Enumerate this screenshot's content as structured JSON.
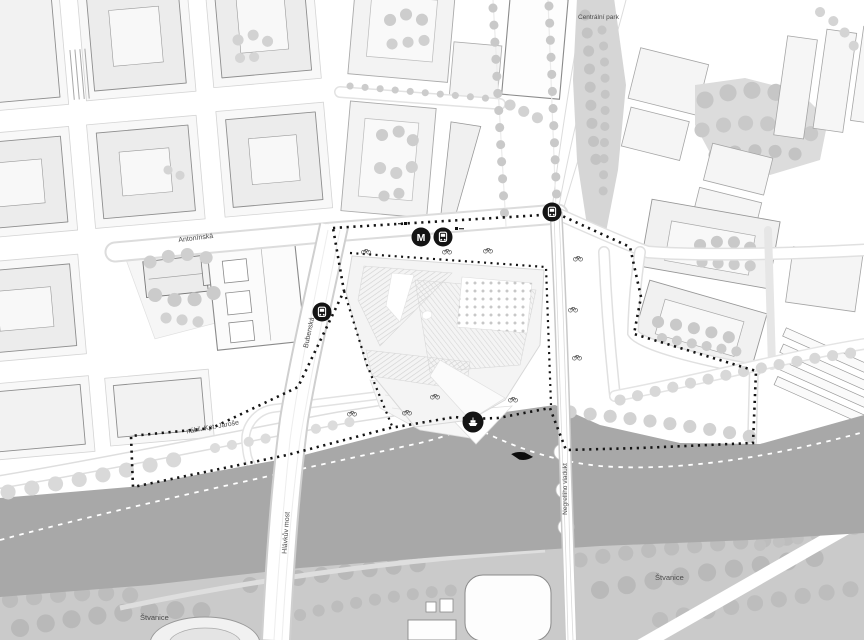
{
  "labels": {
    "central_park": "Centrální park",
    "antoninska": "Antonínská",
    "bubenska": "Bubenská",
    "nabr_kpt_jarose": "nábř. Kpt. Jaroše",
    "hlavkuv_most": "Hlávkův most",
    "negrelliho_viadukt": "Negrelliho viadukt",
    "stvanice_west": "Štvanice",
    "stvanice_east": "Štvanice"
  },
  "markers": {
    "metro": {
      "icon": "metro-icon",
      "label": "M"
    },
    "tram_stop_icons": 3,
    "ferry_stop_icon": "ferry-icon",
    "boat_icon": "boat-icon",
    "bicycle_icon_count": 10
  },
  "colors": {
    "river": "#a8a8a8",
    "island": "#cacaca",
    "island_tree": "#bdbdbd",
    "park": "#d6d6d6",
    "park_tree": "#c5c5c5",
    "street_tree": "#c9c9c9",
    "block_fill": "#ececec",
    "block_outline": "#8e8e8e",
    "marker_bg": "#141414",
    "boundary": "#141414"
  }
}
